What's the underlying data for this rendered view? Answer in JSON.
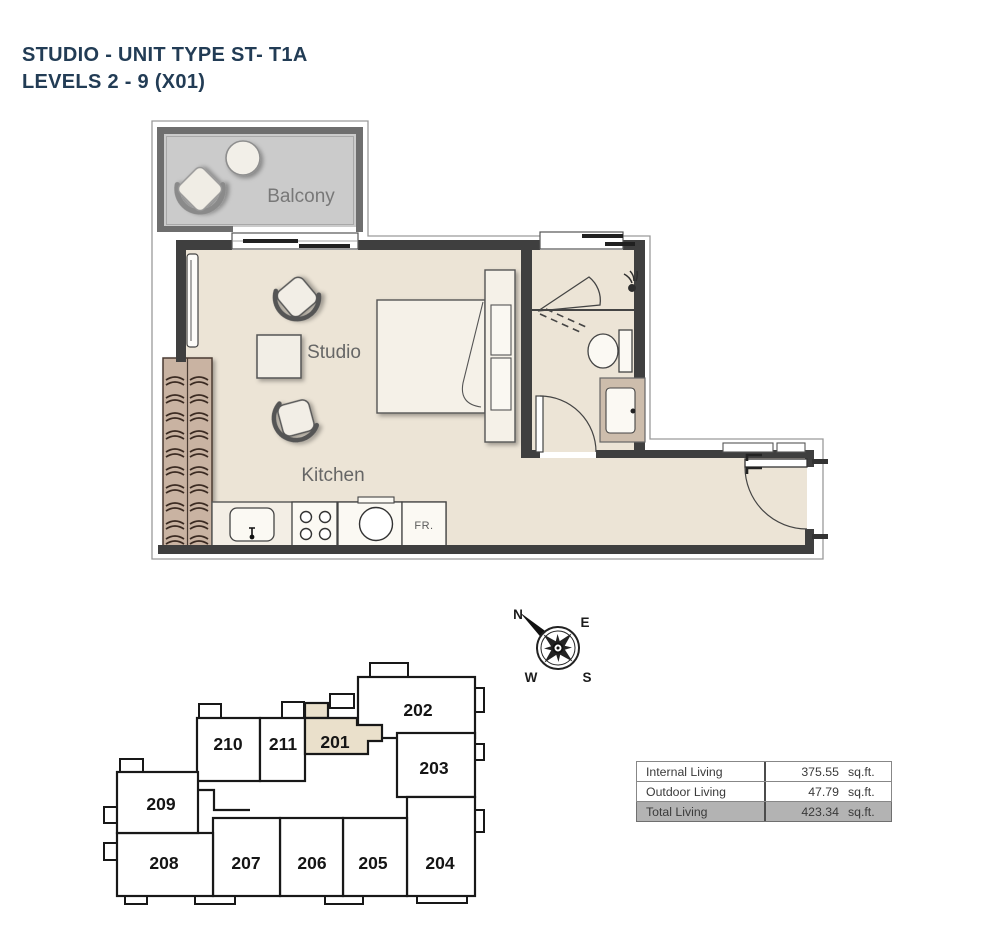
{
  "title": {
    "line1": "STUDIO - UNIT TYPE ST- T1A",
    "line2": "LEVELS 2 - 9 (X01)"
  },
  "floor_plan": {
    "room_labels": {
      "balcony": "Balcony",
      "studio": "Studio",
      "kitchen": "Kitchen"
    },
    "appliance_labels": {
      "fridge": "FR."
    }
  },
  "compass": {
    "north": "N",
    "east": "E",
    "south": "S",
    "west": "W"
  },
  "key_plan": {
    "highlighted_unit": "201",
    "units": [
      {
        "label": "201"
      },
      {
        "label": "202"
      },
      {
        "label": "203"
      },
      {
        "label": "204"
      },
      {
        "label": "205"
      },
      {
        "label": "206"
      },
      {
        "label": "207"
      },
      {
        "label": "208"
      },
      {
        "label": "209"
      },
      {
        "label": "210"
      },
      {
        "label": "211"
      }
    ]
  },
  "area_table": {
    "rows": [
      {
        "label": "Internal Living",
        "value": "375.55",
        "unit": "sq.ft."
      },
      {
        "label": "Outdoor Living",
        "value": "47.79",
        "unit": "sq.ft."
      },
      {
        "label": "Total Living",
        "value": "423.34",
        "unit": "sq.ft."
      }
    ]
  },
  "colors": {
    "title_text": "#223c55",
    "floor_fill": "#ece4d6",
    "balcony_fill": "#cbcbcb",
    "wardrobe_fill": "#c9b3a2",
    "wall_dark": "#3f3f3f",
    "highlight_unit_fill": "#eae0cb",
    "table_total_bg": "#b3b3b3"
  }
}
